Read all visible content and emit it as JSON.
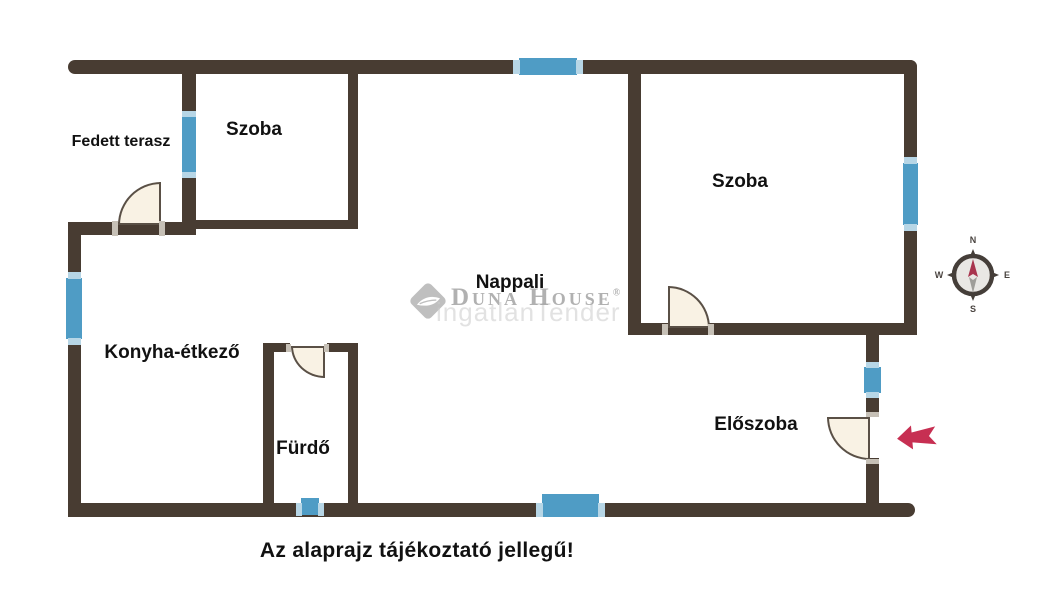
{
  "rooms": {
    "terrace": "Fedett terasz",
    "bedroom_left": "Szoba",
    "bedroom_right": "Szoba",
    "living_room": "Nappali",
    "kitchen_dining": "Konyha-étkező",
    "bathroom": "Fürdő",
    "hallway": "Előszoba"
  },
  "caption": "Az alaprajz tájékoztató jellegű!",
  "watermark": {
    "brand": "Duna House",
    "registered": "®",
    "secondary": "ingatlanTender"
  },
  "compass": {
    "north": "N",
    "east": "E",
    "south": "S",
    "west": "W"
  },
  "colors": {
    "wall": "#483c32",
    "window": "#4f9cc5",
    "window_cap": "#b7d6e6",
    "door_fill": "#f9f2e4",
    "door_stroke": "#5a5046",
    "jamb": "#c6c0b6",
    "arrow": "#c72f52",
    "needle_red": "#a8344e",
    "needle_gray": "#9f9d99",
    "watermark": "#9e9e9e",
    "watermark_light": "#cccccc",
    "text": "#111111"
  }
}
